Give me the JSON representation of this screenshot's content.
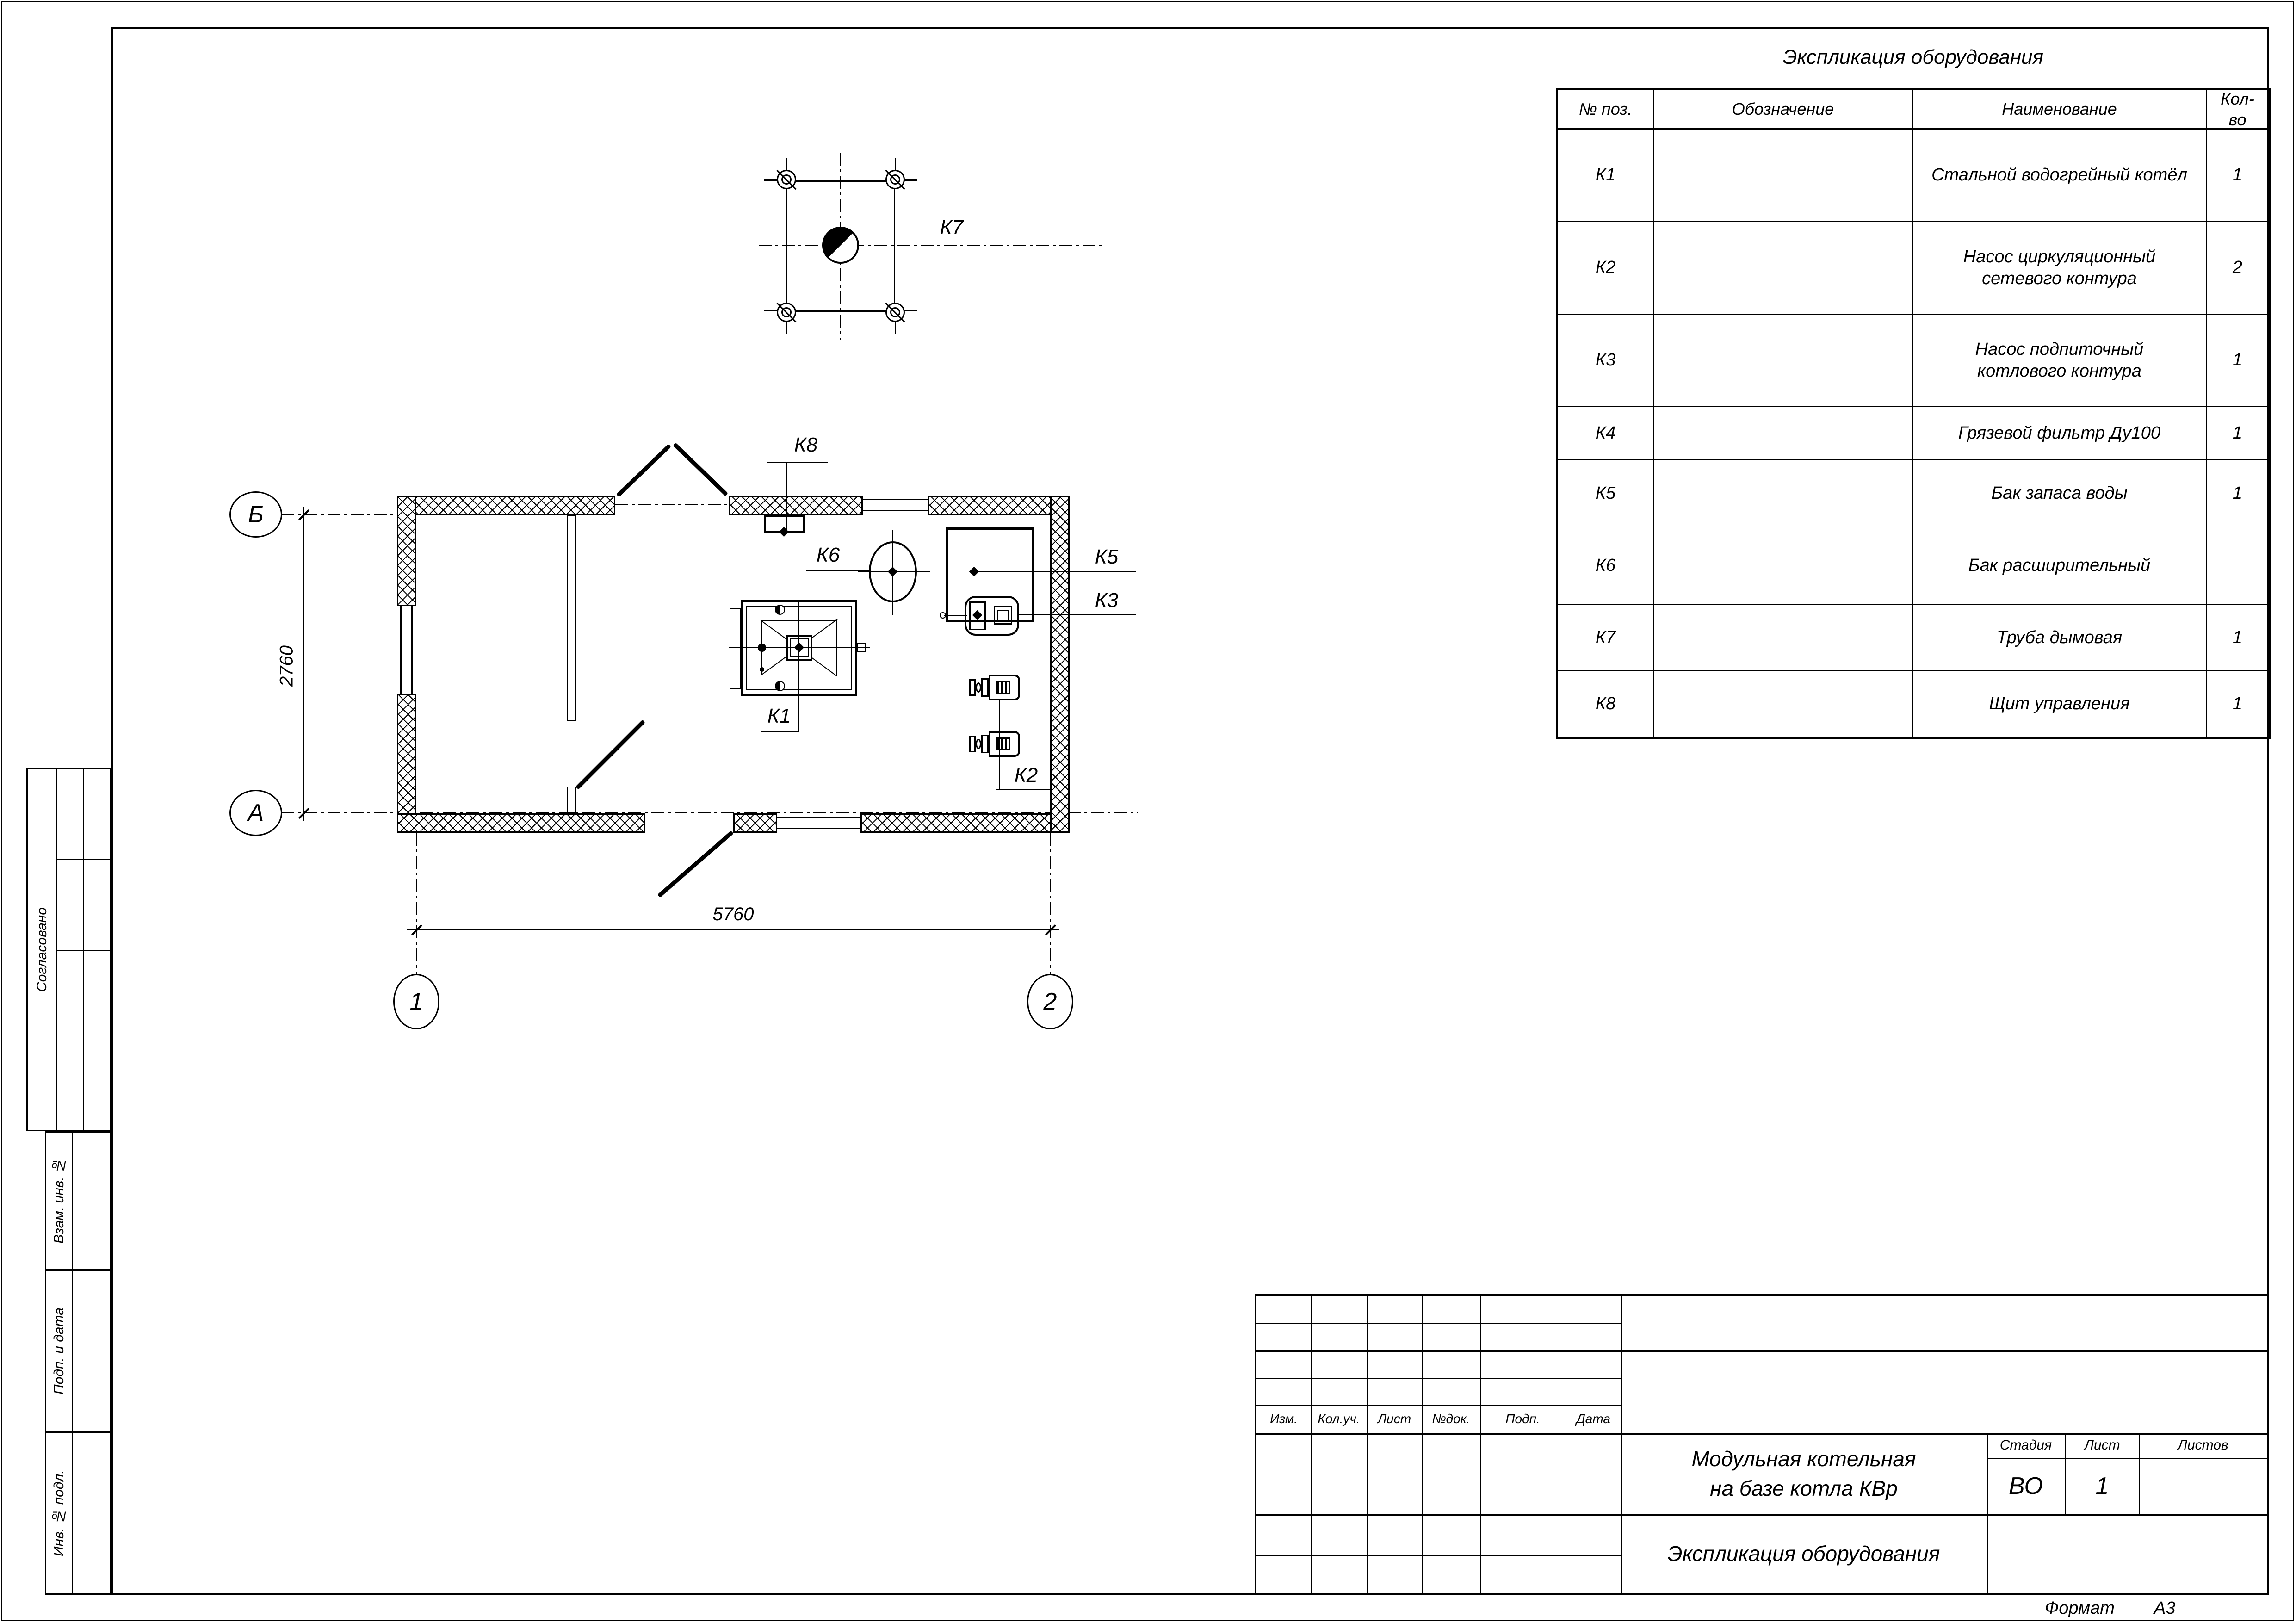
{
  "colors": {
    "line": "#000000",
    "background": "#ffffff"
  },
  "sheet": {
    "format_label": "Формат",
    "format_value": "А3"
  },
  "side_stamp": {
    "agreed": "Согласовано",
    "inv_replace": "Взам. инв. №",
    "sign_date": "Подп. и дата",
    "inv_orig": "Инв. № подл."
  },
  "equipment_table": {
    "title": "Экспликация оборудования",
    "columns": {
      "pos": "№ поз.",
      "designation": "Обозначение",
      "name": "Наименование",
      "qty": "Кол-во"
    },
    "rows": [
      {
        "pos": "К1",
        "designation": "",
        "name": "Стальной водогрейный котёл",
        "qty": "1"
      },
      {
        "pos": "К2",
        "designation": "",
        "name": "Насос циркуляционный сетевого контура",
        "qty": "2"
      },
      {
        "pos": "К3",
        "designation": "",
        "name": "Насос подпиточный котлового контура",
        "qty": "1"
      },
      {
        "pos": "К4",
        "designation": "",
        "name": "Грязевой фильтр Ду100",
        "qty": "1"
      },
      {
        "pos": "К5",
        "designation": "",
        "name": "Бак запаса воды",
        "qty": "1"
      },
      {
        "pos": "К6",
        "designation": "",
        "name": "Бак расширительный",
        "qty": ""
      },
      {
        "pos": "К7",
        "designation": "",
        "name": "Труба дымовая",
        "qty": "1"
      },
      {
        "pos": "К8",
        "designation": "",
        "name": "Щит управления",
        "qty": "1"
      }
    ]
  },
  "plan": {
    "axes": {
      "row_top": "Б",
      "row_bottom": "А",
      "col_left": "1",
      "col_right": "2"
    },
    "dimensions": {
      "vertical": "2760",
      "horizontal": "5760"
    },
    "labels": {
      "k1": "К1",
      "k2": "К2",
      "k3": "К3",
      "k5": "К5",
      "k6": "К6",
      "k7": "К7",
      "k8": "К8"
    }
  },
  "title_block": {
    "revision_header": {
      "izm": "Изм.",
      "koluch": "Кол.уч.",
      "list": "Лист",
      "ndok": "№док.",
      "podp": "Подп.",
      "data": "Дата"
    },
    "project_title_line1": "Модульная котельная",
    "project_title_line2": "на базе котла КВр",
    "sheet_title": "Экспликация оборудования",
    "stage_label": "Стадия",
    "sheet_label": "Лист",
    "sheets_label": "Листов",
    "stage_value": "ВО",
    "sheet_value": "1",
    "sheets_value": ""
  }
}
